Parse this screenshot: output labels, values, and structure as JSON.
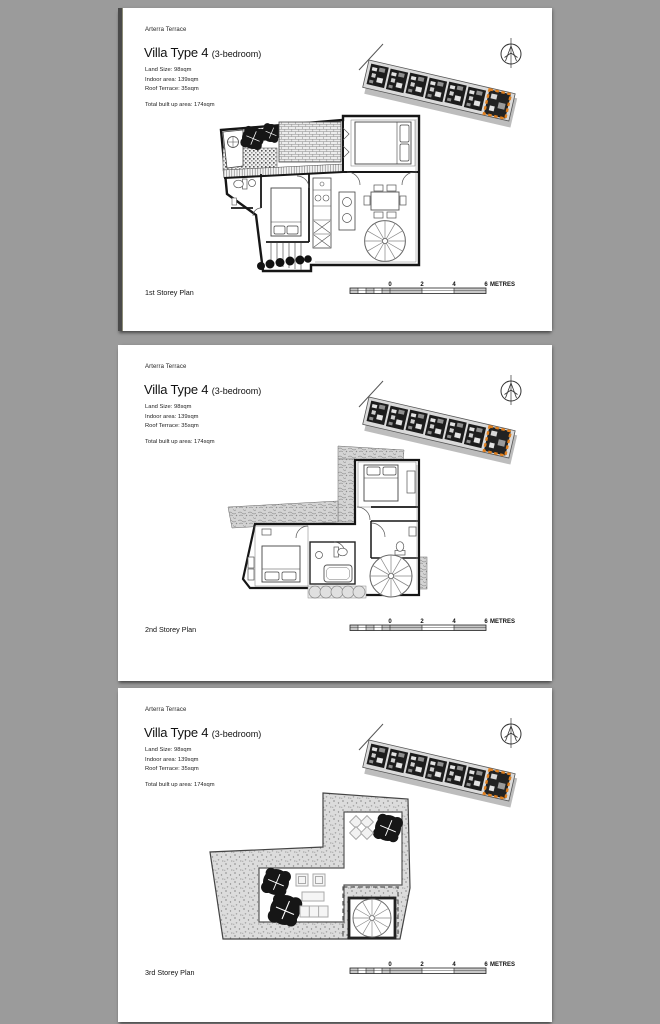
{
  "viewer": {
    "background": "#9b9b9b"
  },
  "colors": {
    "page": "#ffffff",
    "ink": "#1a1a1a",
    "highlight_orange": "#e2811f",
    "drawing_gray": "#888888"
  },
  "icons": {
    "north_arrow": "compass-north-arrow",
    "site_locator": "site-plan-strip-highlighted-unit"
  },
  "pages": [
    {
      "project": "Arterra Terrace",
      "title": "Villa Type 4",
      "title_suffix": "(3-bedroom)",
      "details": {
        "land": "Land Size: 98sqm",
        "indoor": "Indoor area: 139sqm",
        "roof": "Roof Terrace: 35sqm",
        "total": "Total built up area: 174sqm"
      },
      "plan_label": "1st Storey Plan",
      "scale": {
        "t0": "0",
        "t2": "2",
        "t4": "4",
        "t6": "6",
        "unit": "METRES"
      }
    },
    {
      "project": "Arterra Terrace",
      "title": "Villa Type 4",
      "title_suffix": "(3-bedroom)",
      "details": {
        "land": "Land Size: 98sqm",
        "indoor": "Indoor area: 139sqm",
        "roof": "Roof Terrace: 35sqm",
        "total": "Total built up area: 174sqm"
      },
      "plan_label": "2nd Storey Plan",
      "scale": {
        "t0": "0",
        "t2": "2",
        "t4": "4",
        "t6": "6",
        "unit": "METRES"
      }
    },
    {
      "project": "Arterra Terrace",
      "title": "Villa Type 4",
      "title_suffix": "(3-bedroom)",
      "details": {
        "land": "Land Size: 98sqm",
        "indoor": "Indoor area: 139sqm",
        "roof": "Roof Terrace: 35sqm",
        "total": "Total built up area: 174sqm"
      },
      "plan_label": "3rd Storey Plan",
      "scale": {
        "t0": "0",
        "t2": "2",
        "t4": "4",
        "t6": "6",
        "unit": "METRES"
      }
    }
  ]
}
